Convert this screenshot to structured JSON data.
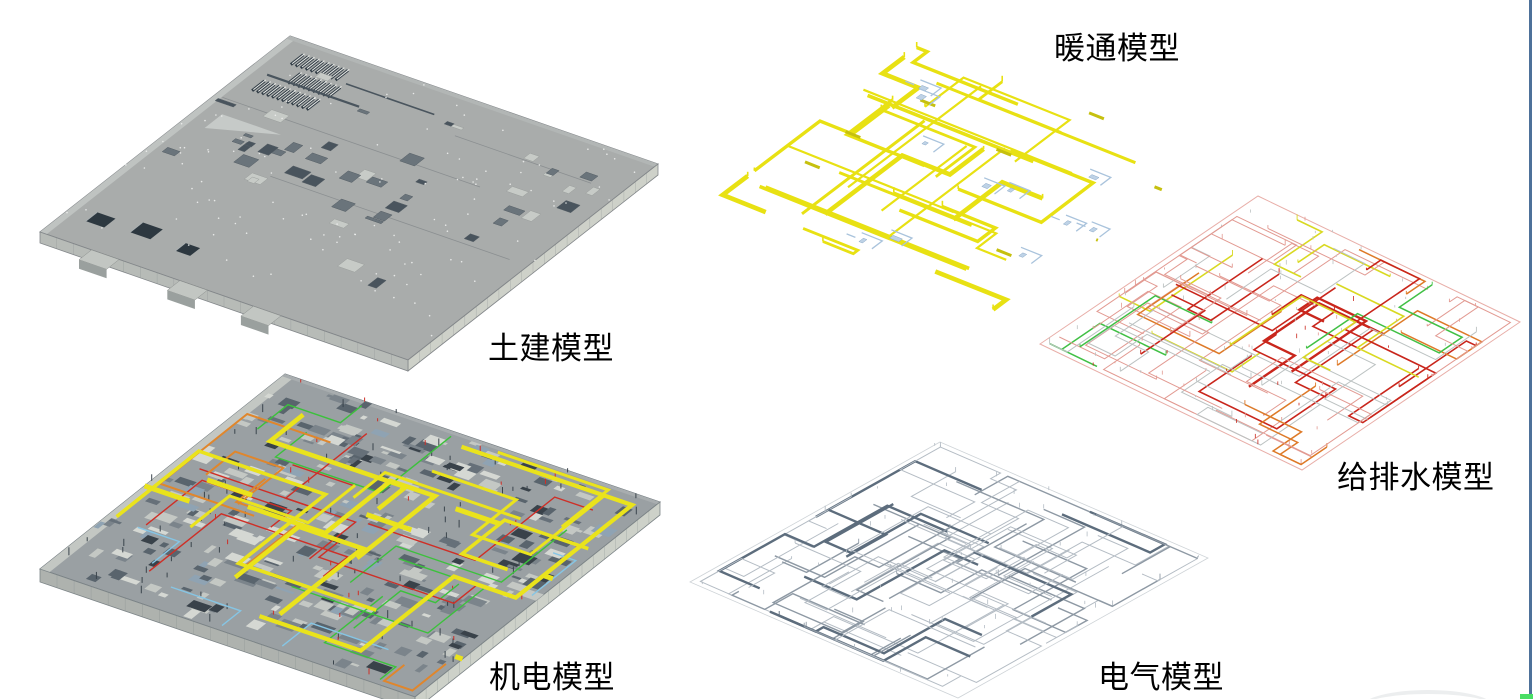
{
  "panels": {
    "civil": {
      "label": "土建模型"
    },
    "mep": {
      "label": "机电模型"
    },
    "hvac": {
      "label": "暖通模型"
    },
    "plumbing": {
      "label": "给排水模型"
    },
    "electrical": {
      "label": "电气模型"
    }
  },
  "colors": {
    "background": "#ffffff",
    "caption_text": "#000000",
    "civil": {
      "slab_top": "#a9acab",
      "fascia_light": "#ced1c9",
      "fascia_mid": "#b7bbb7",
      "edge": "#83878a",
      "dark_structure": "#49545d",
      "louver_dark": "#333e47",
      "pit": "#2d3840",
      "speck": "#eef0ee",
      "light_block": "#c7cbc7"
    },
    "mep": {
      "base": "#9aa0a3",
      "fascia": "#cdd1c9",
      "fascia_side": "#aeb2ae",
      "duct_yellow": "#eae31c",
      "pipe_orange": "#e0862c",
      "pipe_red": "#ce2f27",
      "pipe_green": "#3cc13c",
      "pipe_blue": "#86c5e4",
      "dark_block": "#59646d"
    },
    "hvac": {
      "duct_yellow": "#e8e113",
      "duct_yellow_dark": "#c6c00f",
      "equipment_blue": "#a9c3dc",
      "equipment_fill": "#bed2e6",
      "equipment_edge": "#8caac8"
    },
    "plumbing": {
      "pink": "#e29a92",
      "red": "#c9261c",
      "orange": "#de7a28",
      "green": "#41c045",
      "yellow": "#d9d922",
      "gray": "#bcc2c2"
    },
    "electrical": {
      "light": "#b4bcc4",
      "mid": "#8e99a4",
      "dark": "#5d6d7d",
      "boundary": "#c2c8cd"
    },
    "frame": {
      "right_border_blue": "#4e719a",
      "corner_green": "#49de65",
      "watermark_arc": "#eceeef"
    }
  }
}
